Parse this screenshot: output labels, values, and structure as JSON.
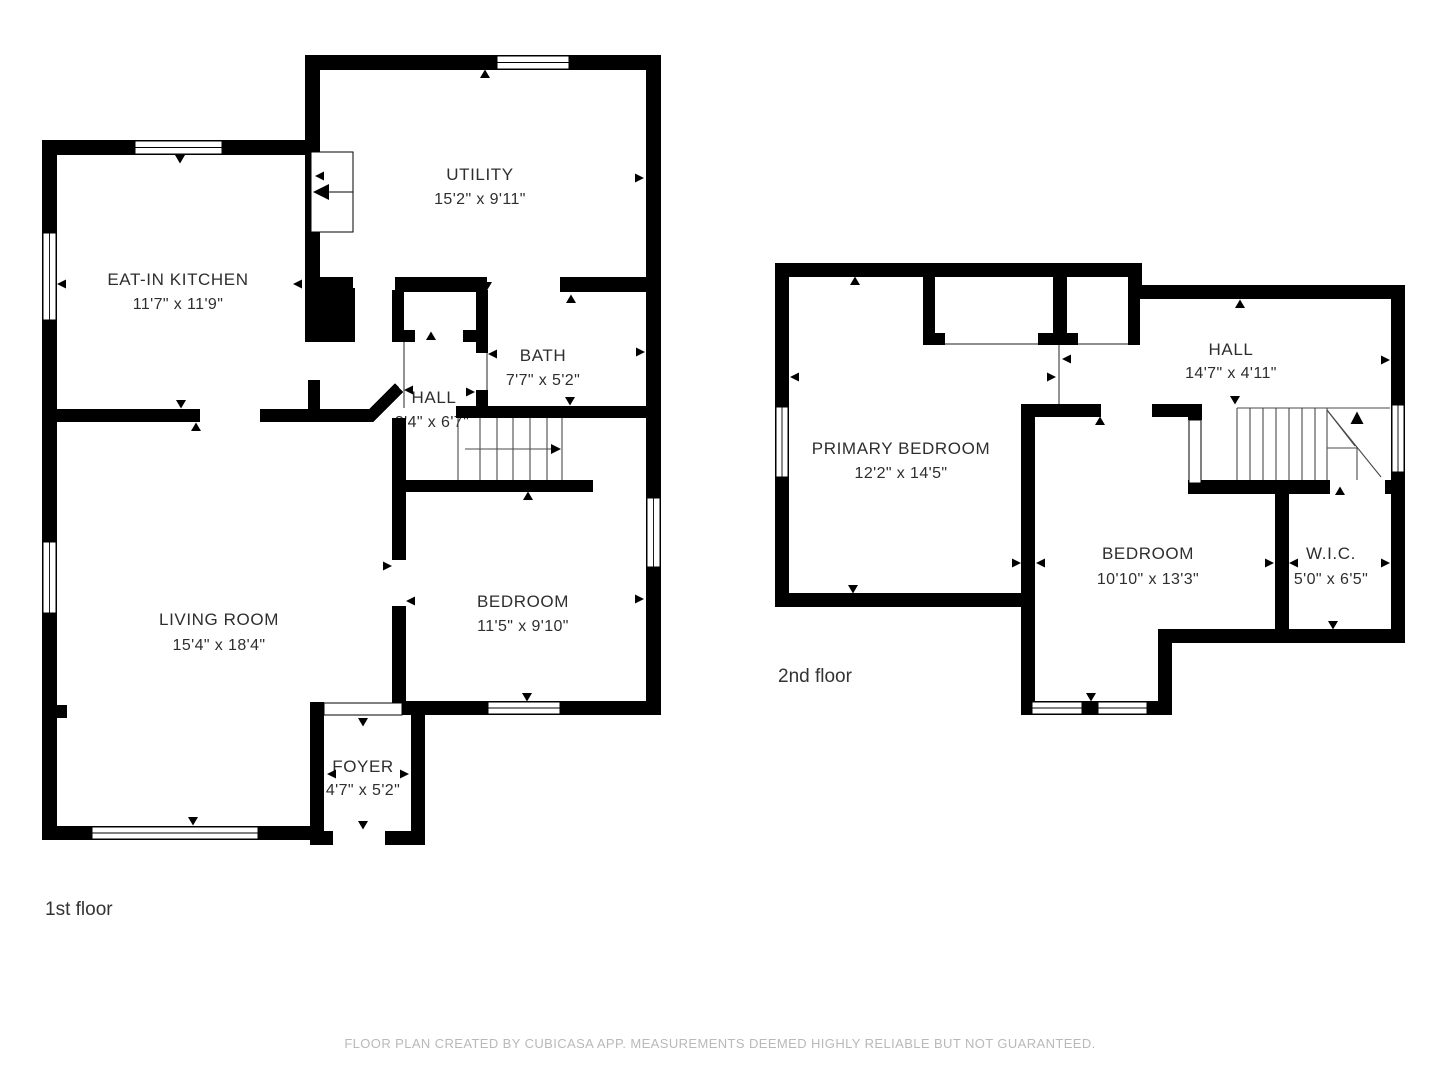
{
  "footer": "FLOOR PLAN CREATED BY CUBICASA APP. MEASUREMENTS DEEMED HIGHLY RELIABLE BUT NOT GUARANTEED.",
  "colors": {
    "wall": "#000000",
    "background": "#ffffff",
    "label_text": "#2e2e2e",
    "footer_text": "#b9b9b9"
  },
  "floors": [
    {
      "label": "1st floor",
      "rooms": [
        {
          "name": "UTILITY",
          "dims": "15'2\" x 9'11\""
        },
        {
          "name": "EAT-IN KITCHEN",
          "dims": "11'7\" x 11'9\""
        },
        {
          "name": "BATH",
          "dims": "7'7\" x 5'2\""
        },
        {
          "name": "HALL",
          "dims": "3'4\" x 6'7\""
        },
        {
          "name": "LIVING ROOM",
          "dims": "15'4\" x 18'4\""
        },
        {
          "name": "BEDROOM",
          "dims": "11'5\" x 9'10\""
        },
        {
          "name": "FOYER",
          "dims": "4'7\" x 5'2\""
        }
      ]
    },
    {
      "label": "2nd floor",
      "rooms": [
        {
          "name": "PRIMARY BEDROOM",
          "dims": "12'2\" x 14'5\""
        },
        {
          "name": "HALL",
          "dims": "14'7\" x 4'11\""
        },
        {
          "name": "BEDROOM",
          "dims": "10'10\" x 13'3\""
        },
        {
          "name": "W.I.C.",
          "dims": "5'0\" x 6'5\""
        }
      ]
    }
  ]
}
